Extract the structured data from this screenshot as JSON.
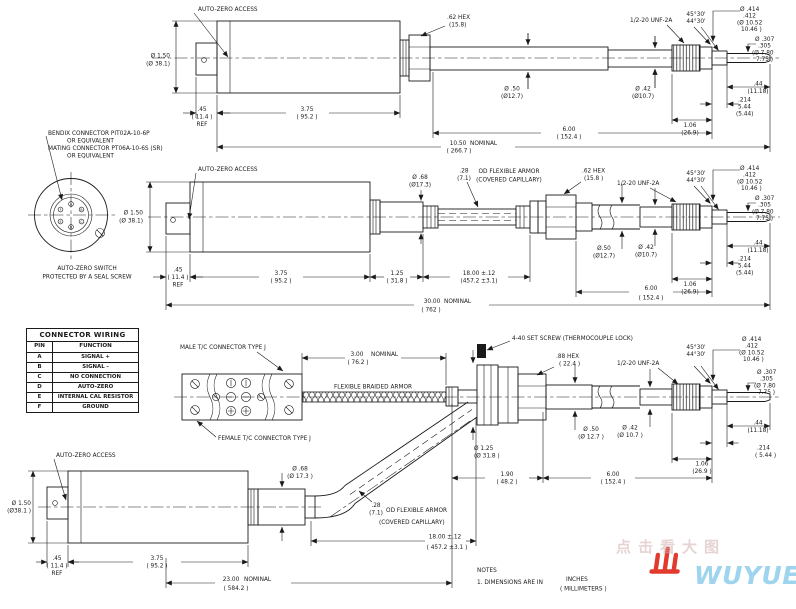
{
  "colors": {
    "ink": "#1a1a1a",
    "background": "#ffffff",
    "logo_red": "#e23b2e",
    "logo_blue": "#9fd4ef",
    "watermark": "#d2afaf"
  },
  "conn": {
    "callout": [
      "BENDIX CONNECTOR PIT02A-10-6P",
      "OR EQUIVALENT",
      "MATING CONNECTOR PT06A-10-6S (SR)",
      "OR EQUIVALENT"
    ],
    "caption": [
      "AUTO-ZERO SWITCH",
      "PROTECTED BY A SEAL SCREW"
    ],
    "pins": [
      "A",
      "B",
      "C",
      "D",
      "E",
      "F"
    ]
  },
  "table": {
    "title": "CONNECTOR WIRING",
    "headers": [
      "PIN",
      "FUNCTION"
    ],
    "rows": [
      [
        "A",
        "SIGNAL +"
      ],
      [
        "B",
        "SIGNAL -"
      ],
      [
        "C",
        "NO CONNECTION"
      ],
      [
        "D",
        "AUTO-ZERO"
      ],
      [
        "E",
        "INTERNAL CAL RESISTOR"
      ],
      [
        "F",
        "GROUND"
      ]
    ]
  },
  "v1": {
    "az": "AUTO-ZERO ACCESS",
    "body_dia": [
      "Ø 1.50",
      "(Ø 38.1)"
    ],
    "ref": [
      ".45",
      "( 11.4 )",
      "REF"
    ],
    "blen": [
      "3.75",
      "( 95.2 )"
    ],
    "hex": [
      ".62 HEX",
      "(15.8)"
    ],
    "tube": [
      "Ø .50",
      "(Ø12.7)"
    ],
    "thread": "1/2-20 UNF-2A",
    "shaft": [
      "Ø .42",
      "(Ø10.7)"
    ],
    "ang": [
      "45°30'",
      "44°30'"
    ],
    "tdia": [
      "Ø .414",
      ".412",
      "(Ø 10.52",
      "10.46 )"
    ],
    "pdia": [
      "Ø .307",
      ".305",
      "(Ø 7.80",
      "7.75 )"
    ],
    "tlen": [
      ".44",
      "(11.18)"
    ],
    "slen": [
      ".214",
      "5.44",
      "(5.44)"
    ],
    "thlen": [
      "1.06",
      "(26.9)"
    ],
    "plen": [
      "6.00",
      "( 152.4 )"
    ],
    "overall": [
      "10.50",
      "NOMINAL",
      "( 266.7 )"
    ]
  },
  "v2": {
    "az": "AUTO-ZERO ACCESS",
    "body_dia": [
      "Ø 1.50",
      "(Ø 38.1)"
    ],
    "ref": [
      ".45",
      "( 11.4 )",
      "REF"
    ],
    "blen": [
      "3.75",
      "( 95.2 )"
    ],
    "neck": [
      "1.25",
      "( 31.8 )"
    ],
    "adia": [
      "Ø .68",
      "(Ø17.3)"
    ],
    "aod": [
      ".28",
      "(7.1)"
    ],
    "albl": [
      "OD FLEXIBLE ARMOR",
      "(COVERED CAPILLARY)"
    ],
    "hex": [
      ".62 HEX",
      "(15.8 )"
    ],
    "thread": "1/2-20 UNF-2A",
    "tube": [
      "Ø.50",
      "(Ø12.7)"
    ],
    "shaft": [
      "Ø .42",
      "(Ø10.7)"
    ],
    "ang": [
      "45°30'",
      "44°30'"
    ],
    "tdia": [
      "Ø .414",
      ".412",
      "(Ø 10.52",
      "10.46 )"
    ],
    "pdia": [
      "Ø .307",
      ".305",
      "(Ø 7.80",
      "7.75 )"
    ],
    "tlen": [
      ".44",
      "(11.18)"
    ],
    "slen": [
      ".214",
      "5.44",
      "(5.44)"
    ],
    "thlen": [
      "1.06",
      "(26.9)"
    ],
    "alen": [
      "18.00 ±.12",
      "(457.2 ±3.1)"
    ],
    "plen": [
      "6.00",
      "( 152.4 )"
    ],
    "overall": [
      "30.00",
      "NOMINAL",
      "( 762 )"
    ]
  },
  "v3": {
    "male": "MALE T/C CONNECTOR TYPE J",
    "female": "FEMALE T/C CONNECTOR TYPE J",
    "braid": "FLEXIBLE BRAIDED ARMOR",
    "blen": [
      "3.00",
      "( 76.2 )",
      "NOMINAL"
    ],
    "screw": "4-40 SET SCREW (THERMOCOUPLE LOCK)",
    "hex": [
      ".88 HEX",
      "( 22.4 )"
    ],
    "thread": "1/2-20 UNF-2A",
    "tube": [
      "Ø .50",
      "(Ø 12.7 )"
    ],
    "shaft": [
      "Ø .42",
      "(Ø 10.7 )"
    ],
    "flange": [
      "Ø 1.25",
      "(Ø 31.8 )"
    ],
    "fit": [
      "1.90",
      "( 48.2 )"
    ],
    "plen": [
      "6.00",
      "( 152.4 )"
    ],
    "ang": [
      "45°30'",
      "44°30'"
    ],
    "tdia": [
      "Ø .414",
      ".412",
      "(Ø 10.52",
      "10.46 )"
    ],
    "pdia": [
      "Ø .307",
      ".305",
      "(Ø 7.80",
      "7.75 )"
    ],
    "tlen": [
      ".44",
      "(11.18)"
    ],
    "slen": [
      ".214",
      "( 5.44 )"
    ],
    "thlen": [
      "1.06",
      "(26.9 )"
    ]
  },
  "v4": {
    "az": "AUTO-ZERO ACCESS",
    "body_dia": [
      "Ø 1.50",
      "(Ø38.1 )"
    ],
    "adia": [
      "Ø .68",
      "(Ø 17.3 )"
    ],
    "aod": [
      ".28",
      "(7.1)"
    ],
    "albl": [
      "OD FLEXIBLE ARMOR",
      "(COVERED CAPILLARY)"
    ],
    "alen": [
      "18.00 ±.12",
      "( 457.2 ±3.1 )"
    ],
    "ref": [
      ".45",
      "( 11.4 )",
      "REF"
    ],
    "blen": [
      "3.75",
      "( 95.2 )"
    ],
    "overall": [
      "23.00",
      "NOMINAL",
      "( 584.2 )"
    ]
  },
  "notes": {
    "h": "NOTES",
    "l1": "1. DIMENSIONS ARE IN",
    "u1": "INCHES",
    "u2": "( MILLIMETERS )"
  },
  "brand": {
    "name": "WUYUE",
    "watermark": "点击看大图"
  }
}
